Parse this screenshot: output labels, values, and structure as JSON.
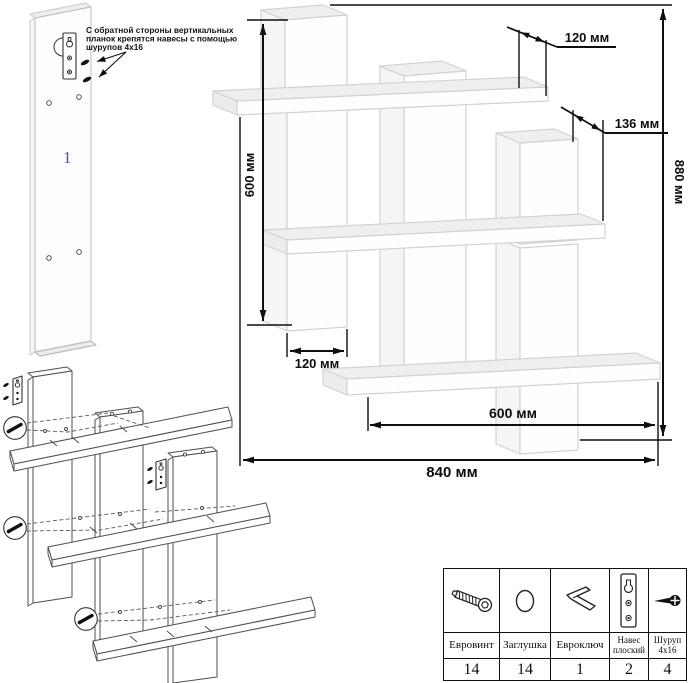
{
  "annotation": {
    "lines": [
      "С обратной стороны вертикальных",
      "планок крепятся навесы с помощью",
      "шурупов 4x16"
    ]
  },
  "part_label": "1",
  "dimensions": {
    "shelf_depth": "120 мм",
    "plank_depth": "136 мм",
    "left_height": "600 мм",
    "total_height": "880 мм",
    "plank_width": "120 мм",
    "shelf_length": "600 мм",
    "total_width": "840 мм"
  },
  "parts_table": {
    "columns": [
      {
        "name": "Евровинт",
        "qty": "14",
        "icon": "confirmat-screw-icon"
      },
      {
        "name": "Заглушка",
        "qty": "14",
        "icon": "cap-plug-icon"
      },
      {
        "name": "Евроключ",
        "qty": "1",
        "icon": "hex-key-icon"
      },
      {
        "name": "Навес плоский",
        "qty": "2",
        "icon": "flat-hanger-icon"
      },
      {
        "name": "Шуруп 4x16",
        "qty": "4",
        "icon": "small-screw-icon"
      }
    ]
  }
}
